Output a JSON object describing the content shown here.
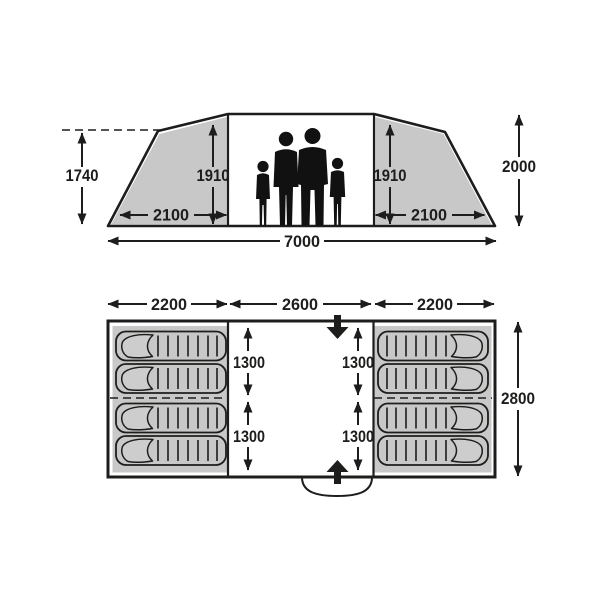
{
  "colors": {
    "panel_gray": "#c8c8c8",
    "line_black": "#1d1d1b",
    "background": "#ffffff",
    "silhouette": "#111111"
  },
  "elevation": {
    "dim_peak_height": "1740",
    "dim_inner_height_left": "1910",
    "dim_inner_height_right": "1910",
    "dim_bedroom_width_left": "2100",
    "dim_bedroom_width_right": "2100",
    "dim_total_height": "2000",
    "dim_total_width": "7000",
    "people_count": 4
  },
  "floor_plan": {
    "dim_left_section_width": "2200",
    "dim_center_section_width": "2600",
    "dim_right_section_width": "2200",
    "dim_total_depth": "2800",
    "dim_left_front_depth": "1300",
    "dim_left_rear_depth": "1300",
    "dim_right_front_depth": "1300",
    "dim_right_rear_depth": "1300",
    "sleeping_bag_count": 8
  },
  "icons": {
    "front_entrance": "thick-down-arrow",
    "rear_entrance": "thick-up-arrow",
    "door_swing": "arc"
  }
}
